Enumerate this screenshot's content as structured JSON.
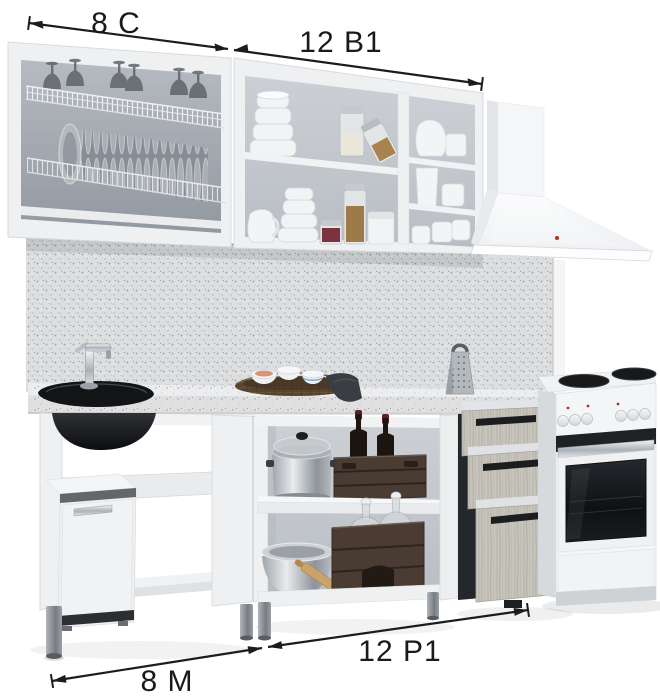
{
  "annotations": {
    "top_left": {
      "label": "8 С"
    },
    "top_right": {
      "label": "12 В1"
    },
    "bottom_left": {
      "label": "8 М"
    },
    "bottom_right": {
      "label": "12 Р1"
    }
  },
  "colors": {
    "background": "#ffffff",
    "annotation_ink": "#1a1a1a",
    "cabinet_white": "#eef0f2",
    "cabinet_interior": "#a8aeb5",
    "backsplash_speckle": "#dcdee0",
    "countertop_speckle": "#ecedee",
    "drawer_front_wood": "#c7c4bc",
    "crate_brown": "#4b3c33",
    "sink_black": "#131416",
    "oven_glass_black": "#17191b",
    "hood_white": "#f5f6f8",
    "indicator_red": "#b33028",
    "leg_gray": "#8a8f94"
  }
}
